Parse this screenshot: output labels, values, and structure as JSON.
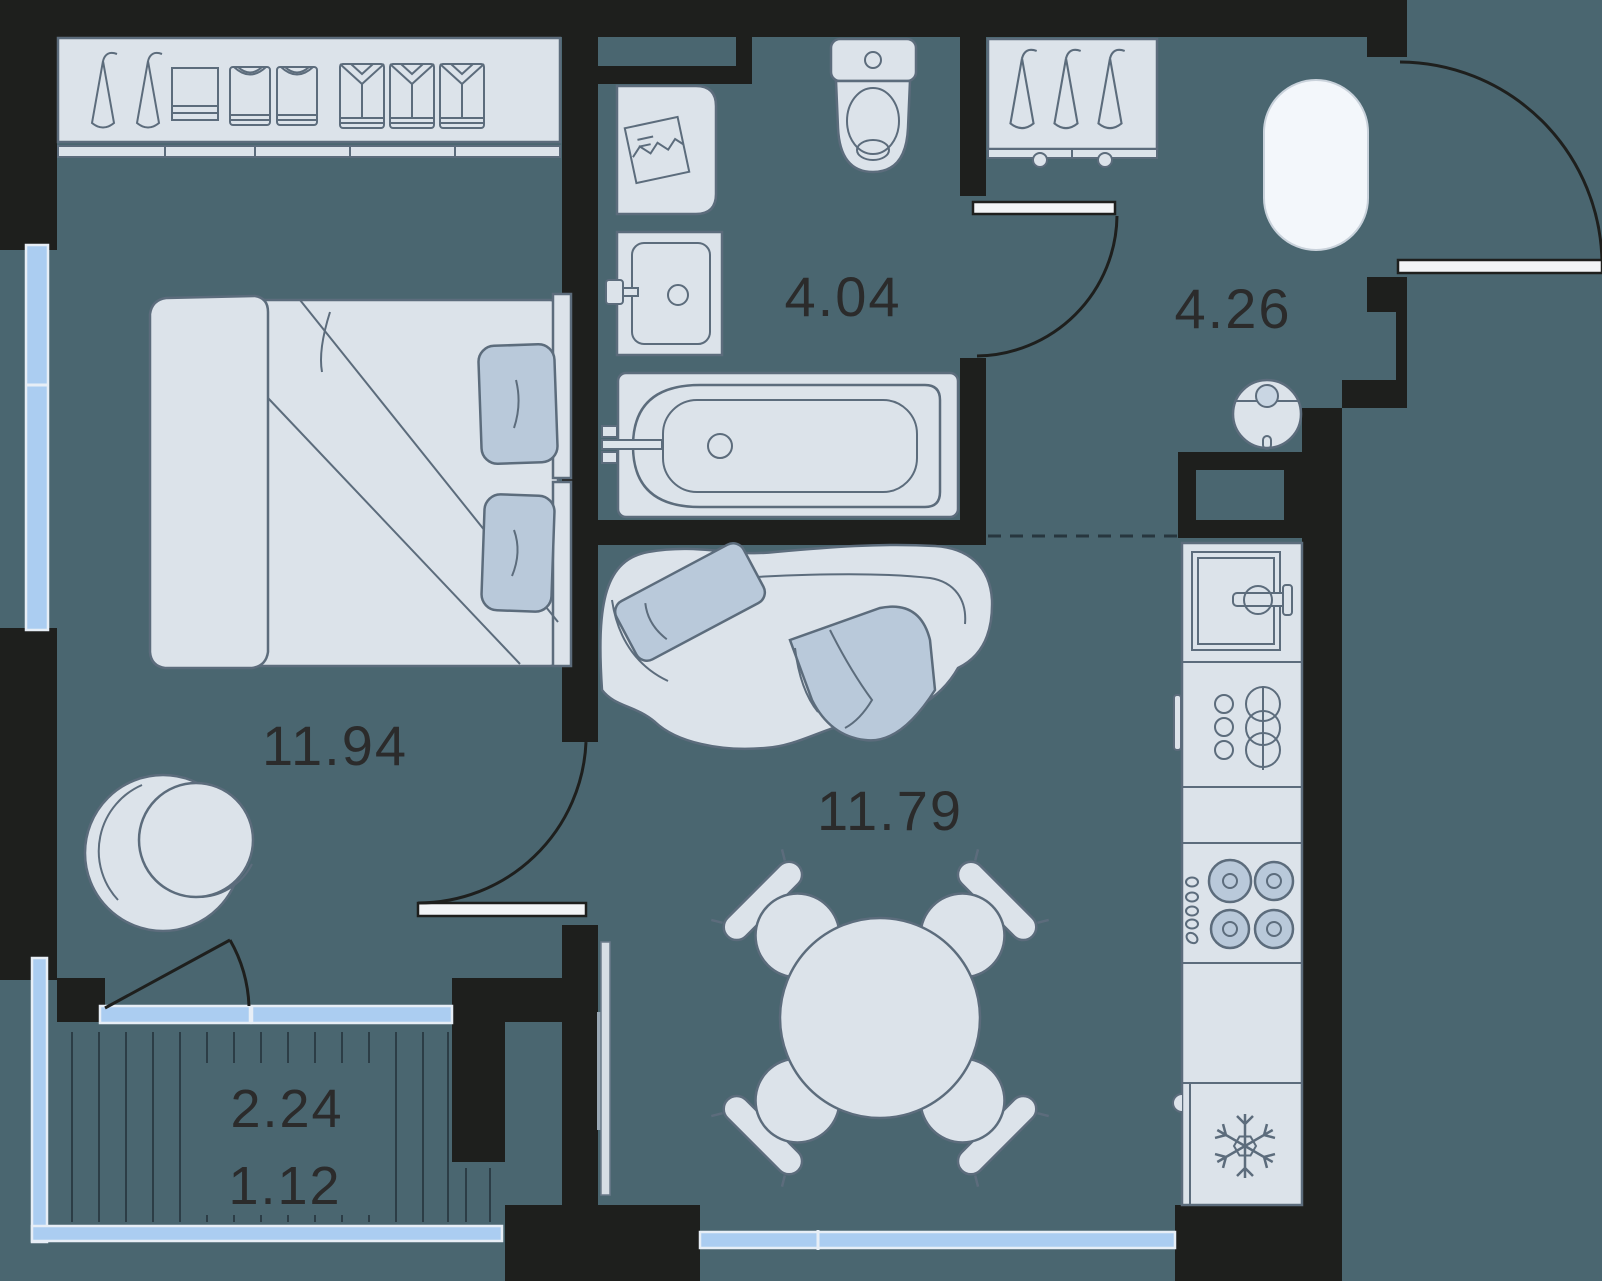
{
  "plan_type": "apartment-floor-plan",
  "rooms": {
    "bedroom": {
      "name": "bedroom",
      "area": "11.94"
    },
    "bathroom": {
      "name": "bathroom",
      "area": "4.04"
    },
    "hallway": {
      "name": "hallway",
      "area": "4.26"
    },
    "living_kitchen": {
      "name": "living-kitchen",
      "area": "11.79"
    },
    "balcony": {
      "name": "balcony",
      "area_total": "2.24",
      "area_counted": "1.12"
    }
  },
  "colors": {
    "floor": "#4A6670",
    "wall": "#1E1F1D",
    "furniture_fill": "#DCE3EA",
    "furniture_stroke": "#5C6C7C",
    "accent_fill": "#B9C9DA",
    "window_glass": "#ABCDF1",
    "window_frame": "#E7EEF6",
    "label_text": "#2B2B2B",
    "highlight": "#F3F7FB"
  },
  "icons": {
    "bedroom": [
      "hanger-icon",
      "folded-clothes-icon",
      "tshirt-icon",
      "shirt-icon",
      "double-bed",
      "pillow",
      "swivel-chair",
      "balcony-door"
    ],
    "bathroom": [
      "washing-machine-icon",
      "washbasin-icon",
      "toilet-icon",
      "bathtub-icon"
    ],
    "hallway": [
      "hanger-icon",
      "oval-pouf",
      "robot-vacuum-icon",
      "entrance-door",
      "ventilation-shaft"
    ],
    "living_kitchen": [
      "sofa",
      "tv",
      "round-dining-table",
      "dining-chair",
      "kitchen-sink-icon",
      "dish-rack-icon",
      "cooktop-icon",
      "fridge-snowflake-icon",
      "window"
    ],
    "balcony": [
      "decking-lines",
      "glazing"
    ]
  }
}
